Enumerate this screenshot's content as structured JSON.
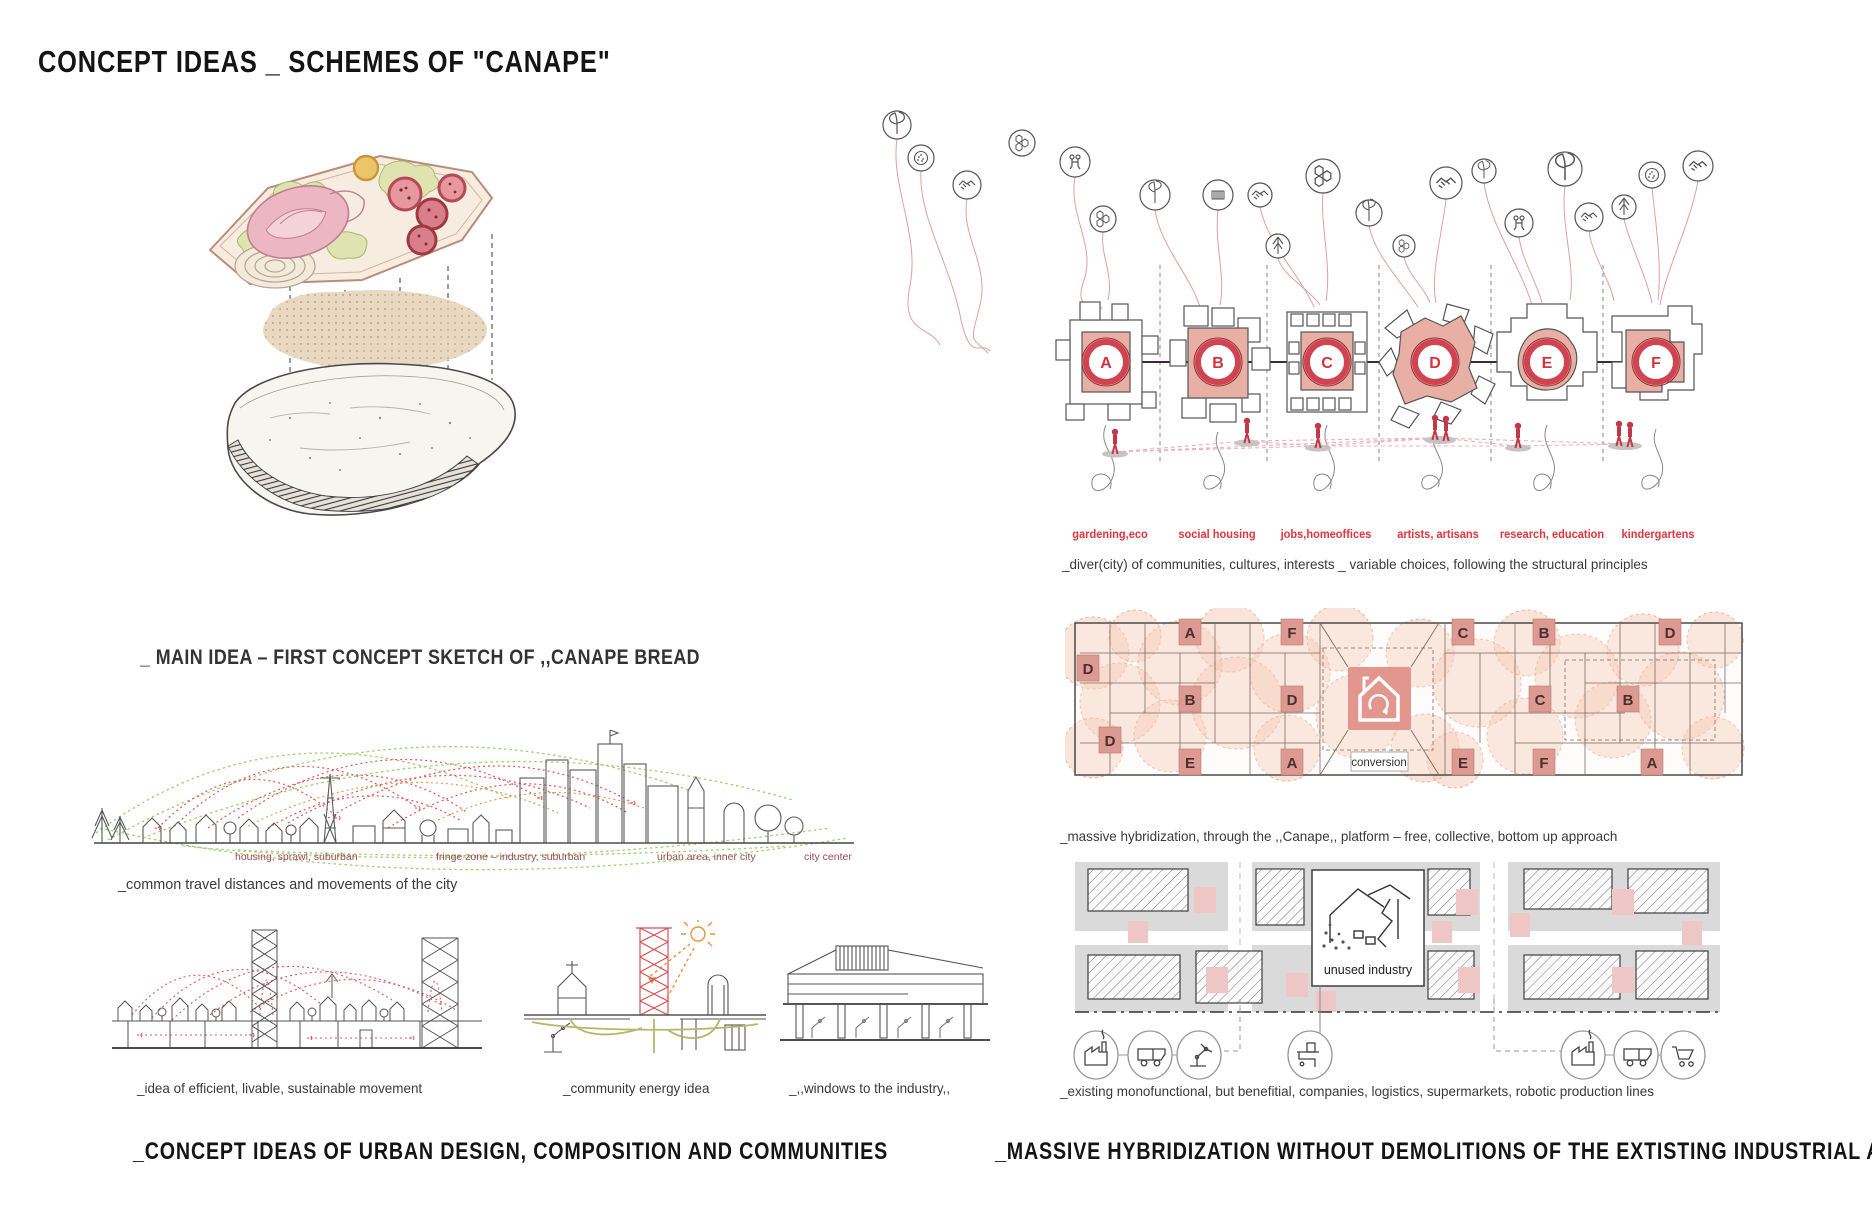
{
  "title": "CONCEPT IDEAS _ SCHEMES OF \"CANAPE\"",
  "left": {
    "main_idea_caption": "_ MAIN IDEA – FIRST CONCEPT SKETCH OF ,,CANAPE BREAD",
    "city_labels": [
      "housing, sprawl, suburban",
      "fringe zone – industry, suburban",
      "urban area, inner city",
      "city center"
    ],
    "travel_caption": "_common travel distances and movements of the city",
    "sketch_captions": [
      "_idea of efficient, livable, sustainable movement",
      "_community energy idea",
      "_,,windows to the industry,,"
    ],
    "section_title": "_CONCEPT IDEAS OF URBAN DESIGN, COMPOSITION AND COMMUNITIES"
  },
  "right": {
    "scheme_letters": [
      "A",
      "B",
      "C",
      "D",
      "E",
      "F"
    ],
    "community_labels": [
      "gardening,eco",
      "social housing",
      "jobs,homeoffices",
      "artists, artisans",
      "research, education",
      "kindergartens"
    ],
    "diversity_caption": "_diver(city) of communities, cultures, interests _  variable choices, following the structural principles",
    "grid_letters": [
      "A",
      "F",
      "C",
      "B",
      "D",
      "D",
      "B",
      "D",
      "C",
      "B",
      "D",
      "E",
      "A",
      "E",
      "F",
      "A"
    ],
    "conversion_label": "conversion",
    "hybridization_caption": "_massive hybridization, through the ,,Canape,, platform – free, collective, bottom up approach",
    "unused_industry_label": "unused industry",
    "industry_caption": "_existing monofunctional, but benefitial, companies, logistics, supermarkets, robotic production lines",
    "section_title": "_MASSIVE HYBRIDIZATION WITHOUT DEMOLITIONS OF THE EXTISTING INDUSTRIAL AREAS",
    "balloon_icon_names": [
      "leaf",
      "cookie",
      "handshake",
      "molecule",
      "people",
      "sprout",
      "tree",
      "music"
    ]
  },
  "colors": {
    "accent_red": "#d8313c",
    "scheme_pink": "#e8afa5",
    "tile_pink": "#dc9a92",
    "bubble_pink": "#f3b79c",
    "label_maroon": "#9e4a50",
    "dotted_green": "#9ed06e",
    "dotted_red": "#e05858",
    "sketch_ink": "#4a4a4a"
  }
}
